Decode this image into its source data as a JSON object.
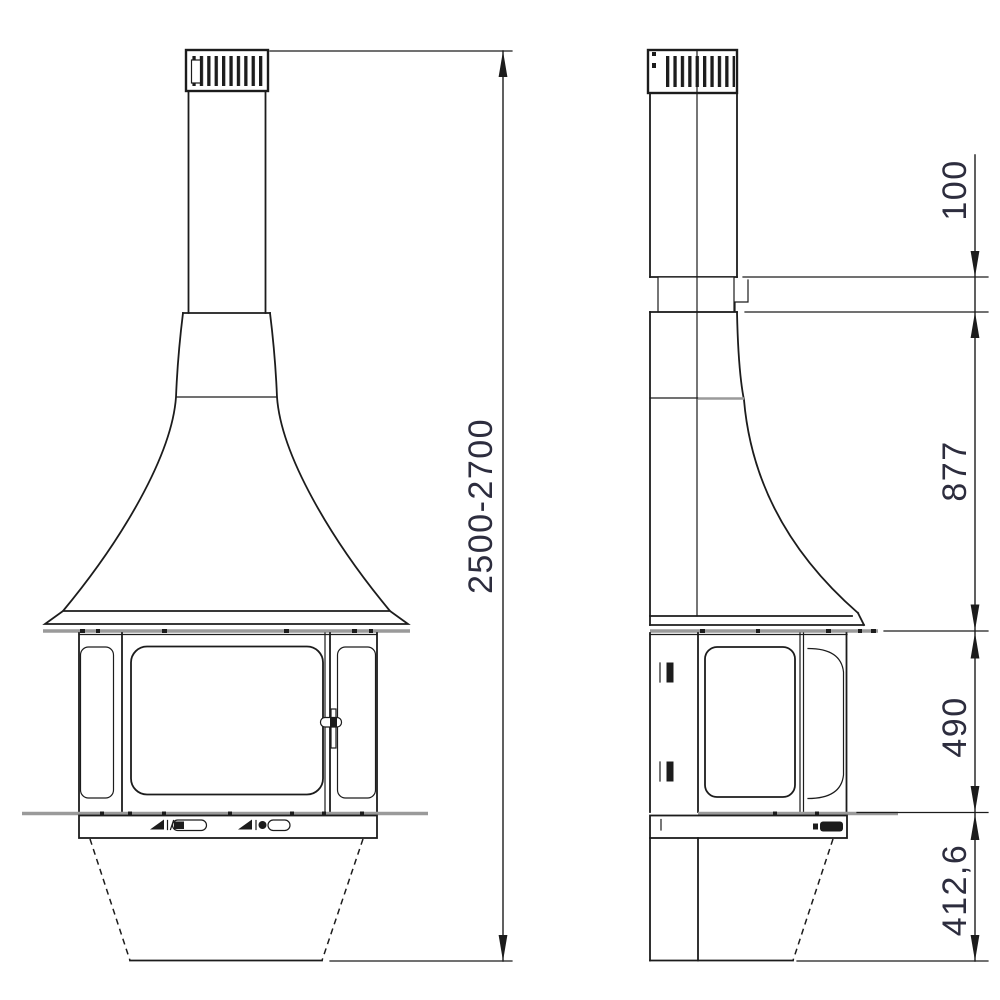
{
  "drawing": {
    "dimensions": {
      "overall_height": "2500-2700",
      "top_offset": "100",
      "hood_height": "877",
      "firebox_height": "490",
      "base_height": "412,6"
    },
    "colors": {
      "line": "#1c1c1c",
      "gray": "#9a9a9a",
      "dim_text": "#2d2d3e",
      "background": "#ffffff"
    }
  }
}
